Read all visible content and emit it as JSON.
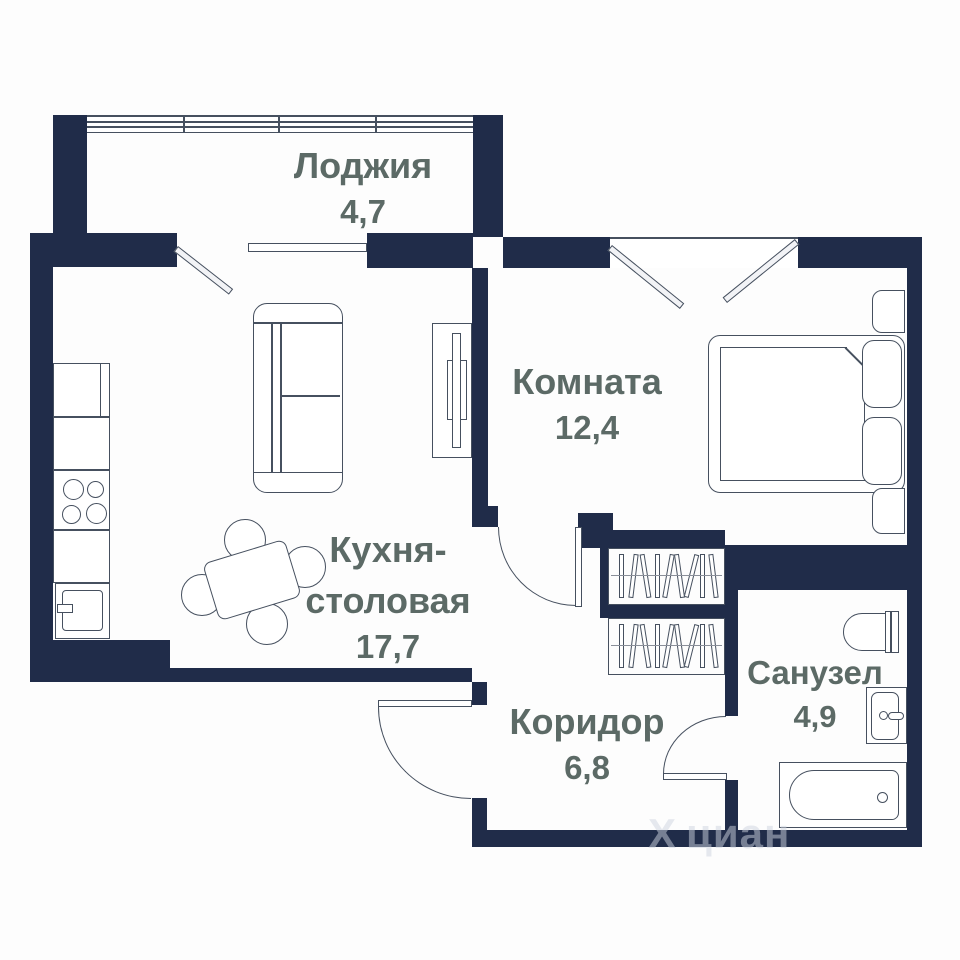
{
  "title": "Floor plan of one-room apartment",
  "rooms": {
    "loggia": {
      "name": "Лоджия",
      "area": "4,7"
    },
    "room": {
      "name": "Комната",
      "area": "12,4"
    },
    "kitchen": {
      "name_line1": "Кухня-",
      "name_line2": "столовая",
      "area": "17,7"
    },
    "corridor": {
      "name": "Коридор",
      "area": "6,8"
    },
    "bathroom": {
      "name": "Санузел",
      "area": "4,9"
    }
  },
  "watermark": {
    "logo": "Х",
    "text": "циан"
  },
  "colors": {
    "wall": "#202c49",
    "label": "#5c6a66",
    "line": "#46505f",
    "bg": "#fdfdfd",
    "watermark": "rgba(206,212,224,0.5)"
  }
}
